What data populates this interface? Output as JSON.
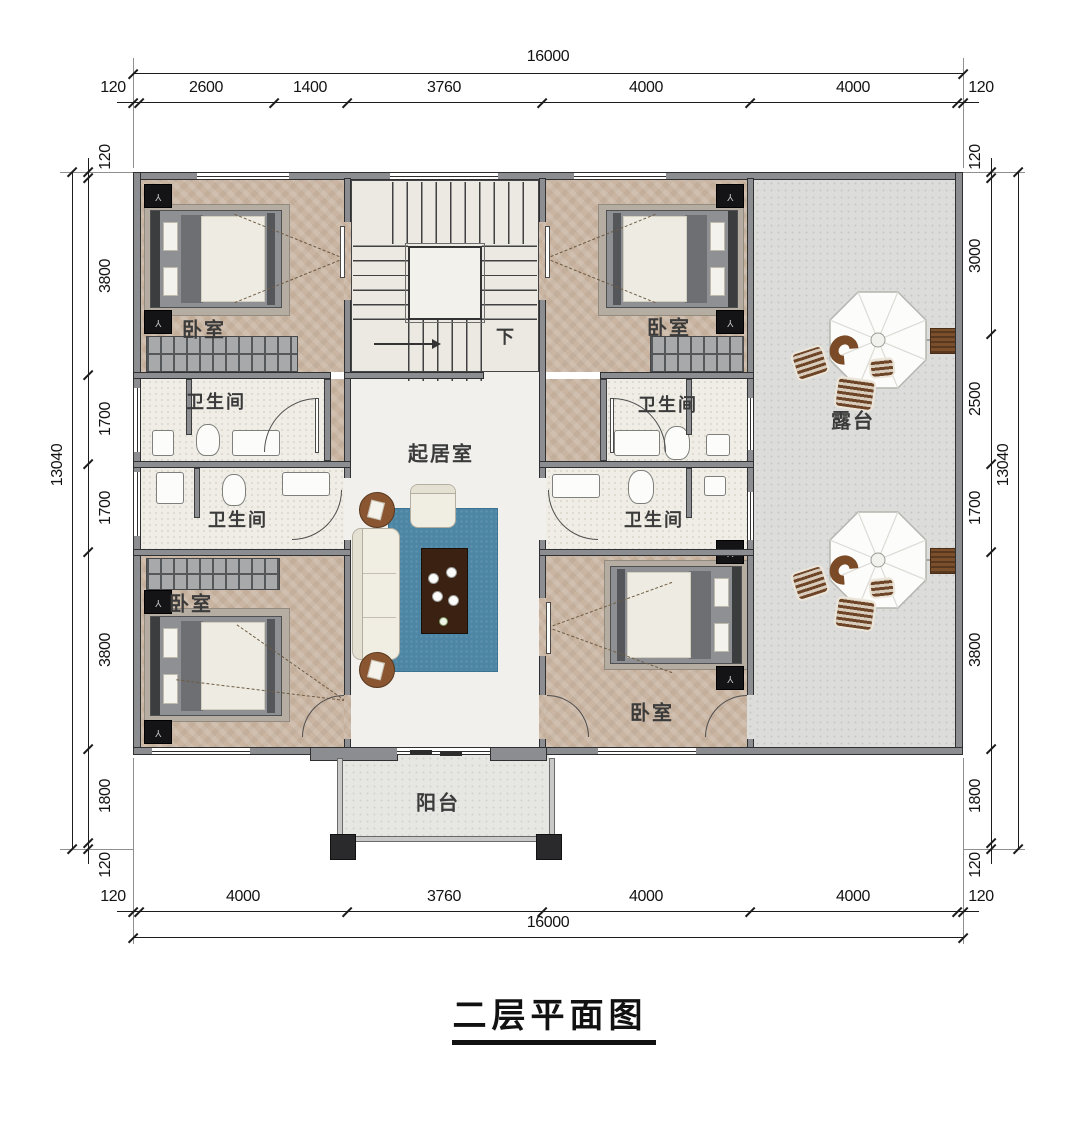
{
  "title": {
    "text": "二层平面图"
  },
  "rooms": {
    "bedroom_tl": "卧室",
    "bedroom_tr": "卧室",
    "bedroom_bl": "卧室",
    "bedroom_br": "卧室",
    "bath_tl": "卫生间",
    "bath_tr": "卫生间",
    "bath_bl": "卫生间",
    "bath_br": "卫生间",
    "living": "起居室",
    "terrace": "露台",
    "balcony": "阳台",
    "stairs_down": "下"
  },
  "dimensions": {
    "top": {
      "overall": "16000",
      "segments": [
        "120",
        "2600",
        "1400",
        "3760",
        "4000",
        "4000",
        "120"
      ]
    },
    "bottom": {
      "overall": "16000",
      "segments": [
        "120",
        "4000",
        "3760",
        "4000",
        "4000",
        "120"
      ]
    },
    "left": {
      "overall": "13040",
      "segments": [
        "120",
        "3800",
        "1700",
        "1700",
        "3800",
        "1800",
        "120"
      ]
    },
    "right": {
      "overall": "13040",
      "segments": [
        "120",
        "3000",
        "2500",
        "1700",
        "3800",
        "1800",
        "120"
      ]
    }
  },
  "colors": {
    "wall": "#8b8d90",
    "bedroom_floor": "#c9b5a2",
    "bath_floor": "#efede5",
    "terrace_floor": "#dcdddb",
    "living_rug": "#4c86a4",
    "wood": "#8a5632",
    "line": "#1c1c1c"
  }
}
